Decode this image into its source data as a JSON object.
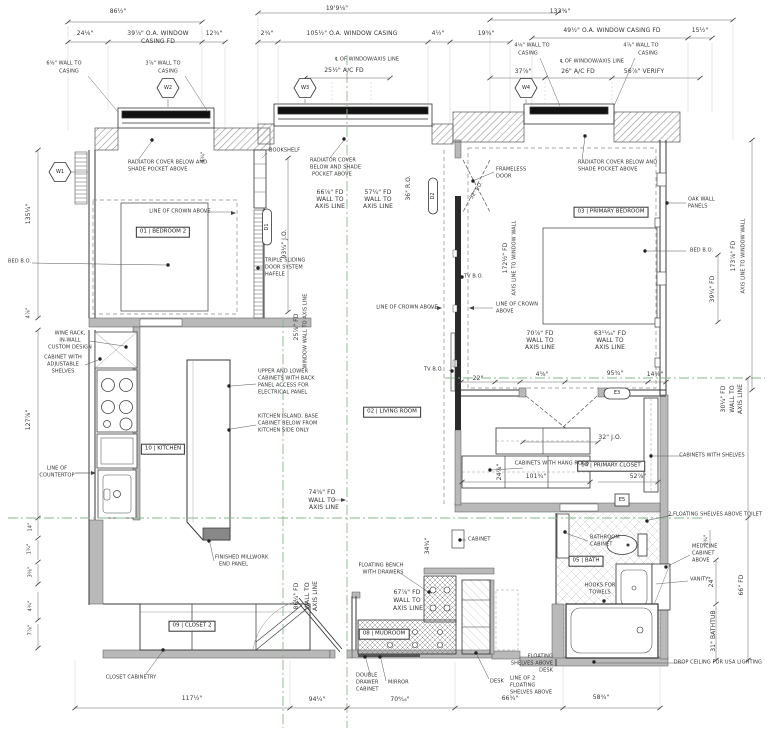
{
  "rooms": {
    "bedroom2": "01 | BEDROOM 2",
    "living": "02 | LIVING ROOM",
    "primary": "03 | PRIMARY BEDROOM",
    "closet": "04 | PRIMARY CLOSET",
    "bath": "05 | BATH",
    "mudroom": "08 | MUDROOM",
    "closet2": "09 | CLOSET 2",
    "kitchen": "10 | KITCHEN"
  },
  "markers": {
    "w1": "W1",
    "w2": "W2",
    "w3": "W3",
    "w4": "W4",
    "d1": "D1",
    "d2": "D2",
    "e3": "E3",
    "e5": "E5"
  },
  "dims": {
    "wall_to": "WALL TO",
    "axis_line": "AXIS LINE",
    "casing": "CASING",
    "left_overall": "86½\"",
    "left_seg1": "24⅛\"",
    "left_window": "39⅞\" O.A. WINDOW",
    "left_window2": "CASING FD",
    "left_seg2": "12¾\"",
    "left_casing1": "6⅝\" WALL TO",
    "left_casing2": "3⅞\" WALL TO",
    "mid_overall": "19'9⅛\"",
    "mid_seg1": "2¾\"",
    "mid_window": "105½\" O.A. WINDOW CASING",
    "mid_seg2": "4½\"",
    "mid_seg3": "19¾\"",
    "mid_centerline": "℄ OF WINDOW/AXIS LINE",
    "mid_ac": "25½\" A/C FD",
    "right_overall": "133⅜\"",
    "right_window": "49½\" O.A. WINDOW CASING FD",
    "right_seg1": "15½\"",
    "right_casing1": "4⅛\" WALL TO",
    "right_casing2": "4⅞\" WALL TO",
    "right_centerline": "℄ OF WINDOW/AXIS LINE",
    "right_seg2": "37⅞\"",
    "right_ac": "26\" A/C FD",
    "right_verify": "56⅞\" VERIFY",
    "hall66": "66⅞\" FD",
    "hall57": "57¼\" FD",
    "ro36": "36\" R.O.",
    "jo93": "93¼\" J.O.",
    "jo32": "32\" J.O.",
    "fd25": "25⅞\" FD",
    "window_wall": "WINDOW WALL TO AXIS LINE",
    "fd172": "172½\" FD",
    "fd172b": "AXIS LINE TO WINDOW WALL",
    "fd173": "173⅞\" FD",
    "fd173b": "AXIS LINE TO WINDOW WALL",
    "fd39": "39¼\" FD",
    "fd70": "70⅞\" FD",
    "fd63": "63¹¹⁄₁₆\" FD",
    "d22": "22\"",
    "d4": "4⅝\"",
    "d95": "95¾\"",
    "d14": "14⅝\"",
    "d101": "101¾\"",
    "d52": "52⅞\"",
    "fd30": "30¼\" FD",
    "d24v": "24⅞\"",
    "fd74": "74⅝\" FD",
    "fd86": "86¼\" FD",
    "fd67": "67⅞\" FD",
    "d34": "34¾\"",
    "b117": "117½\"",
    "b94": "94¼\"",
    "b70": "70⁹⁄₁₆\"",
    "b66": "66¾\"",
    "b58": "58¾\"",
    "v24": "24\"",
    "v66": "66\" FD",
    "v31": "31\" BATHTUB",
    "v2": "2¾\"",
    "l135": "135¼\"",
    "l127": "127⅞\"",
    "l14": "14\"",
    "l1": "1¼\"",
    "l3": "3⅝\"",
    "l4": "4¾\"",
    "l7": "7⅞\"",
    "l4b": "4⅞\"",
    "w4b": "4¾\""
  },
  "notes": {
    "radiator1": "RADIATOR COVER BELOW AND",
    "radiator1b": "SHADE POCKET ABOVE",
    "radiator_mid1": "RADIATOR COVER",
    "radiator_mid2": "BELOW AND SHADE",
    "radiator_mid3": "POCKET ABOVE",
    "bookshelf": "BOOKSHELF",
    "frameless1": "FRAMELESS",
    "frameless2": "DOOR",
    "crown": "LINE OF CROWN ABOVE",
    "crown1": "LINE OF CROWN",
    "crown2": "ABOVE",
    "bed_bo": "BED B.O.",
    "tv_bo": "TV B.O.",
    "oak1": "OAK WALL",
    "oak2": "PANELS",
    "wine1": "WINE RACK,",
    "wine2": "IN-WALL",
    "wine3": "CUSTOM DESIGN",
    "cab1": "CABINET WITH",
    "cab2": "ADJUSTABLE",
    "cab3": "SHELVES",
    "counter1": "LINE OF",
    "counter2": "COUNTERTOP",
    "upper1": "UPPER AND LOWER",
    "upper2": "CABINETS WITH BACK",
    "upper3": "PANEL ACCESS FOR",
    "upper4": "ELECTRICAL PANEL",
    "island1": "KITCHEN ISLAND, BASE",
    "island2": "CABINET BELOW FROM",
    "island3": "KITCHEN SIDE ONLY",
    "triple1": "TRIPLE SLIDING",
    "triple2": "DOOR SYSTEM",
    "triple3": "HAFELE",
    "handrods": "CABINETS WITH HANG RODS",
    "cabshelves": "CABINETS WITH SHELVES",
    "shelves_toilet": "2 FLOATING SHELVES ABOVE TOILET",
    "bathcab1": "BATHROOM",
    "bathcab2": "CABINET",
    "med1": "MEDICINE",
    "med2": "CABINET",
    "med3": "ABOVE",
    "vanity": "VANITY",
    "hooks1": "HOOKS FOR",
    "hooks2": "TOWELS",
    "dropceiling": "DROP CEILING FOR USA LIGHTING",
    "bench1": "FLOATING BENCH",
    "bench2": "WITH DRAWERS",
    "dbl1": "DOUBLE",
    "dbl2": "DRAWER",
    "dbl3": "CABINET",
    "mirror": "MIRROR",
    "desk": "DESK",
    "fsd1": "FLOATING",
    "fsd2": "SHELVES ABOVE",
    "fsd3": "DESK",
    "l2f1": "LINE OF 2",
    "l2f2": "FLOATING",
    "l2f3": "SHELVES ABOVE",
    "closetcab": "CLOSET CABINETRY",
    "millwork1": "FINISHED MILLWORK",
    "millwork2": "END PANEL",
    "cabinet": "CABINET"
  }
}
